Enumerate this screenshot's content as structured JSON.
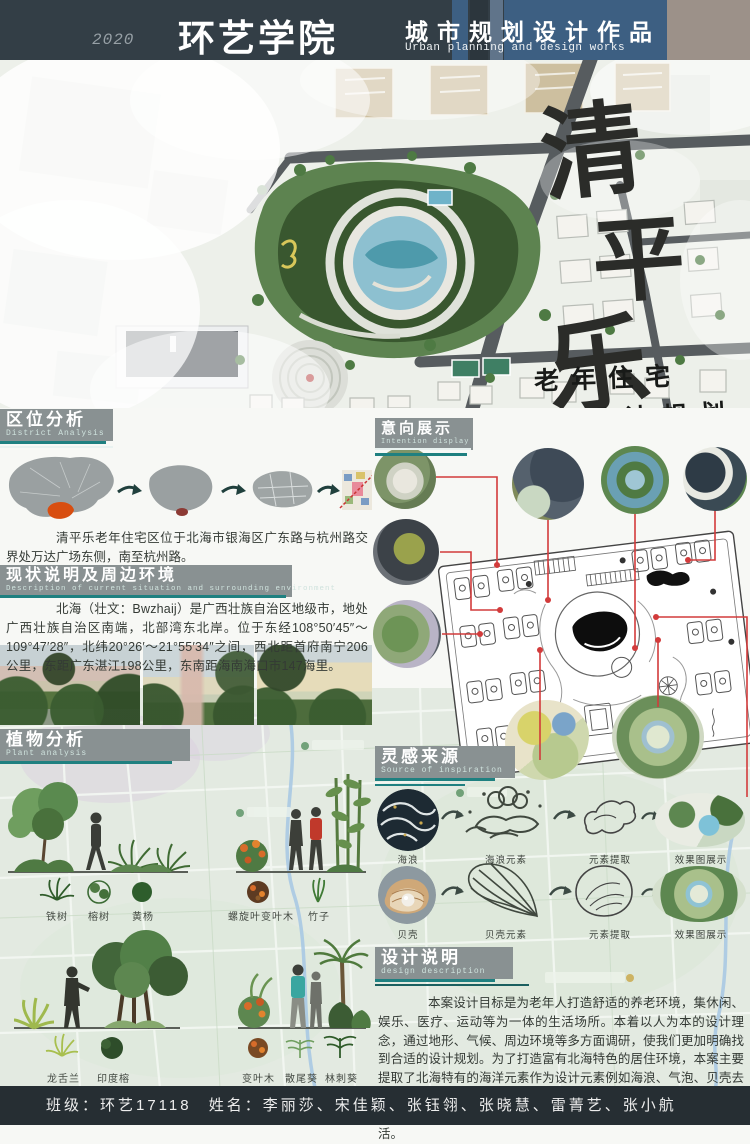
{
  "header": {
    "year": "2020",
    "school": "环艺学院",
    "title_cn": "城市规划设计作品",
    "title_en": "Urban planning and design works"
  },
  "hero": {
    "char1": "清",
    "char2": "平",
    "char3": "乐",
    "subtitle1": "老年住宅",
    "subtitle2": "设计规划"
  },
  "district": {
    "title_cn": "区位分析",
    "title_en": "District Analysis",
    "paragraph": "清平乐老年住宅区位于北海市银海区广东路与杭州路交界处万达广场东侧，南至杭州路。"
  },
  "current": {
    "title_cn": "现状说明及周边环境",
    "title_en": "Description of current situation and surrounding environment",
    "paragraph": "北海（壮文：Bwzhaij）是广西壮族自治区地级市，地处广西壮族自治区南端，北部湾东北岸。位于东经108°50′45″～109°47′28″，北纬20°26′～21°55′34″之间，西北距首府南宁206公里，东距广东湛江198公里，东南距海南海口市147海里。"
  },
  "plant": {
    "title_cn": "植物分析",
    "title_en": "Plant analysis",
    "row1_labels": [
      "铁树",
      "榕树",
      "黄杨",
      "螺旋叶变叶木",
      "竹子"
    ],
    "row2_labels": [
      "龙舌兰",
      "印度榕",
      "变叶木",
      "散尾葵",
      "林刺葵"
    ]
  },
  "intention": {
    "title_cn": "意向展示",
    "title_en": "Intention display"
  },
  "inspiration": {
    "title_cn": "灵感来源",
    "title_en": "Source of inspiration",
    "row1": [
      "海浪",
      "海浪元素",
      "元素提取",
      "效果图展示"
    ],
    "row2": [
      "贝壳",
      "贝壳元素",
      "元素提取",
      "效果图展示"
    ]
  },
  "description": {
    "title_cn": "设计说明",
    "title_en": "design description",
    "paragraph": "本案设计目标是为老年人打造舒适的养老环境，集休闲、娱乐、医疗、运动等为一体的生活场所。本着以人为本的设计理念，通过地形、气候、周边环境等多方面调研，使我们更加明确找到合适的设计规划。为了打造富有北海特色的居住环境，本案主要提取了北海特有的海洋元素作为设计元素例如海浪、气泡、贝壳去联想的空间规划，如同一个复杂的生命系统，我们要创造的是一个有意义的规划，使之在不丢失设计主题的前提下更加适合老年人生活。"
  },
  "footer": {
    "class_text": "班级：环艺17118",
    "names_text": "姓名：李丽莎、宋佳颖、张钰翎、张晓慧、雷菁艺、张小航"
  },
  "colors": {
    "header_dark": "#333e46",
    "header_blue": "#3d5f82",
    "header_taupe": "#9c9189",
    "bar_gray": "#899192",
    "teal_accent": "#1f8080",
    "connector_red": "#d23b3b",
    "highlight_orange": "#d84e10",
    "map_green": "#e3eae1",
    "footer_dark": "#262e33"
  }
}
